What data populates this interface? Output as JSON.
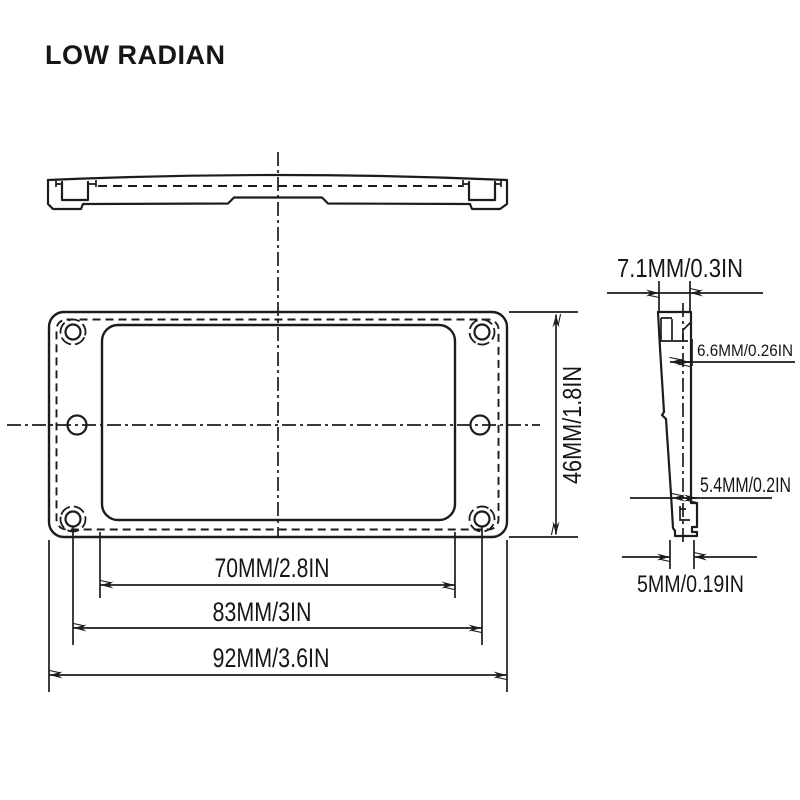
{
  "title": "LOW RADIAN",
  "colors": {
    "line": "#1c1c1c",
    "text": "#161616",
    "background": "#ffffff"
  },
  "front_view": {
    "height_label": "46MM/1.8IN",
    "opening_width_label": "70MM/2.8IN",
    "hole_spacing_label": "83MM/3IN",
    "overall_width_label": "92MM/3.6IN"
  },
  "side_view": {
    "top_width_label": "7.1MM/0.3IN",
    "upper_depth_label": "6.6MM/0.26IN",
    "lower_depth_label": "5.4MM/0.2IN",
    "bottom_width_label": "5MM/0.19IN"
  }
}
